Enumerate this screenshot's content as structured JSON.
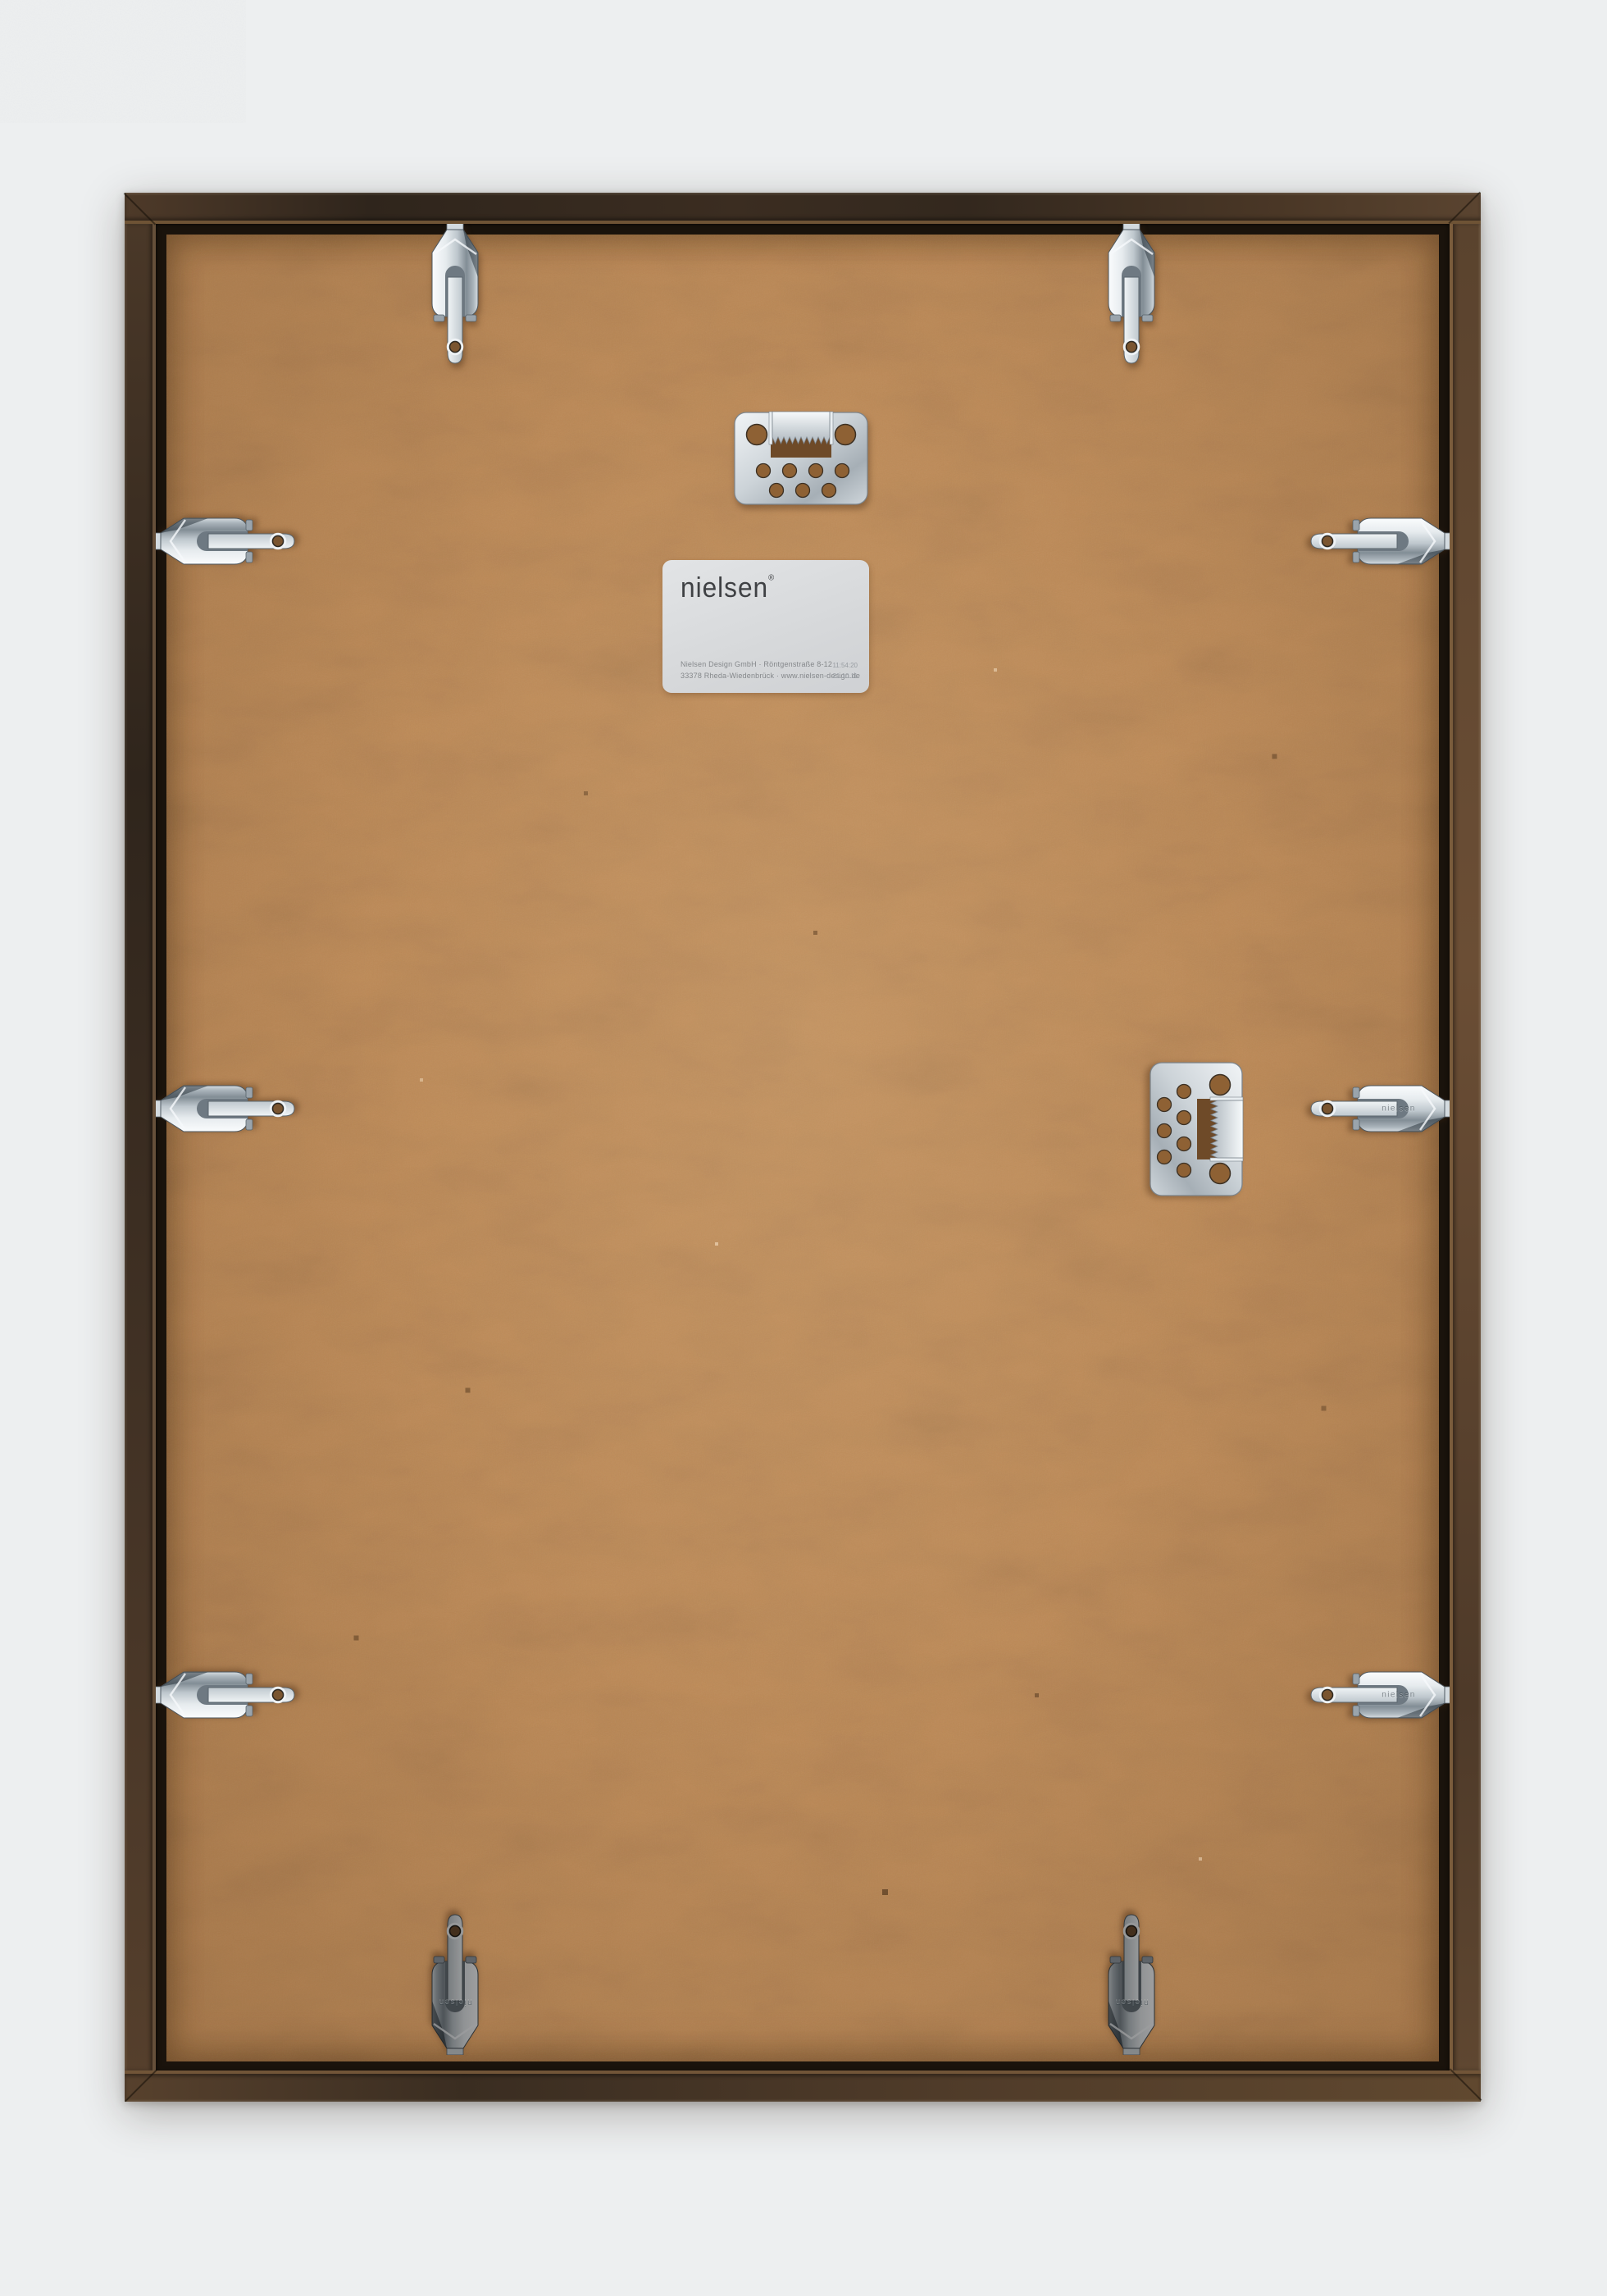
{
  "photo": {
    "subject": "Rear view of a nielsen wooden picture frame with MDF back panel, metal flexi clips and sawtooth hangers",
    "background_color": "#edeff0",
    "frame_color": "#3f3023",
    "board_color": "#c08c58",
    "metal_color": "#ccd4da"
  },
  "label": {
    "brand": "nielsen",
    "registered_mark": "®",
    "address_line1": "Nielsen Design GmbH · Röntgenstraße 8-12",
    "address_line2": "33378 Rheda-Wiedenbrück · www.nielsen-design.de",
    "stamp_line1": "11:54:20",
    "stamp_line2": "21.10.11"
  },
  "hardware": {
    "clip_engraving": "nielsen"
  }
}
